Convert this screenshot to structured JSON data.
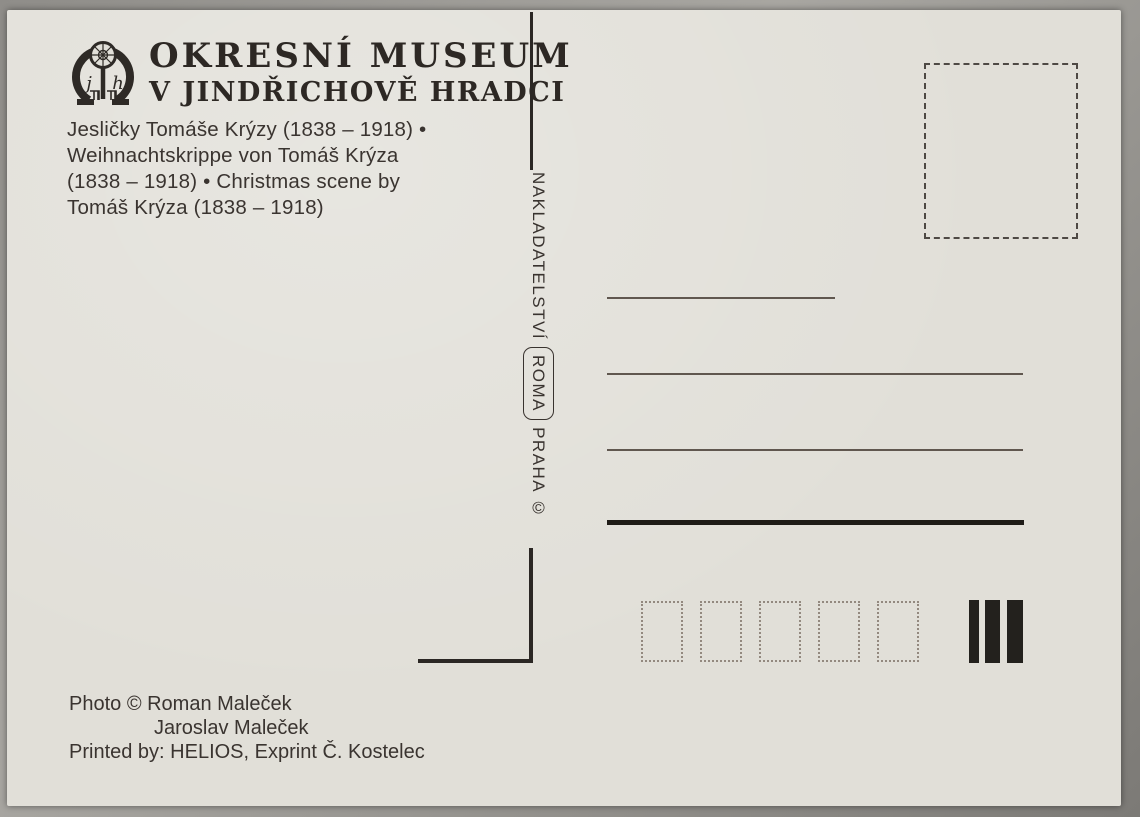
{
  "header": {
    "line1": "OKRESNÍ MUSEUM",
    "line2": "V JINDŘICHOVĚ HRADCI",
    "logo_monogram_left": "j",
    "logo_monogram_right": "h"
  },
  "caption": {
    "lines": [
      "Jesličky Tomáše Krýzy (1838 – 1918) •",
      "Weihnachtskrippe von Tomáš Krýza",
      "(1838 – 1918) • Christmas scene by",
      "Tomáš Krýza (1838 – 1918)"
    ]
  },
  "publisher": {
    "name": "NAKLADATELSTVÍ",
    "brand": "ROMA",
    "city": "PRAHA ©"
  },
  "credits": {
    "line1": "Photo © Roman Maleček",
    "line2": "Jaroslav Maleček",
    "line3": "Printed by: HELIOS, Exprint Č. Kostelec"
  },
  "icons": {
    "museum-logo": "omega-emblem-with-rose-window-and-castle"
  },
  "colors": {
    "card_bg": "#e1dfd8",
    "ink": "#39332f",
    "ink_dark": "#23211d",
    "line_thin": "#60574f",
    "surround": "#8f8d89"
  },
  "postal_code_box_count": "5",
  "printer_bar_count": "3"
}
